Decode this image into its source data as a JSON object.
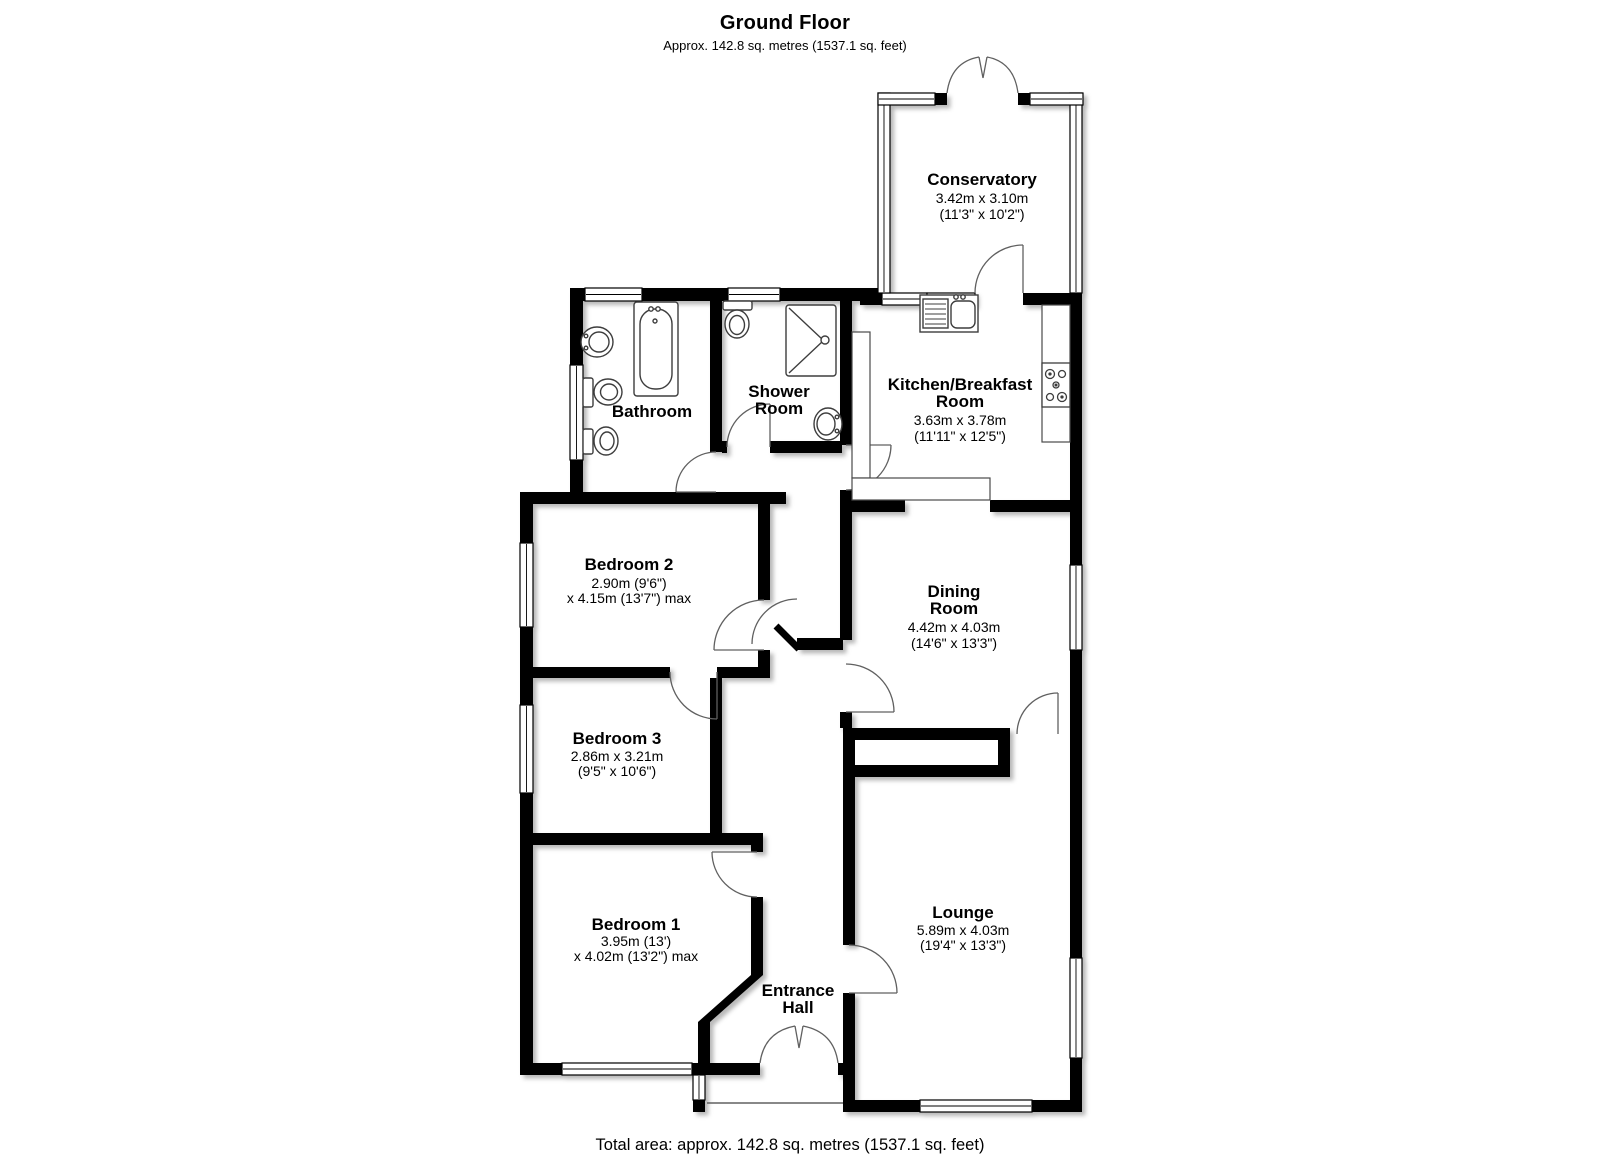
{
  "title": {
    "heading": "Ground Floor",
    "subheading": "Approx. 142.8 sq. metres (1537.1 sq. feet)"
  },
  "footer": {
    "total_area": "Total area: approx. 142.8 sq. metres (1537.1 sq. feet)"
  },
  "rooms": [
    {
      "id": "conservatory",
      "cx": 982,
      "lines": [
        {
          "text": "Conservatory",
          "bold": true,
          "y": 185
        },
        {
          "text": "3.42m x 3.10m",
          "bold": false,
          "y": 203
        },
        {
          "text": "(11'3\" x 10'2\")",
          "bold": false,
          "y": 219
        }
      ]
    },
    {
      "id": "kitchen-breakfast-room",
      "cx": 960,
      "lines": [
        {
          "text": "Kitchen/Breakfast",
          "bold": true,
          "y": 390
        },
        {
          "text": "Room",
          "bold": true,
          "y": 407
        },
        {
          "text": "3.63m x 3.78m",
          "bold": false,
          "y": 425
        },
        {
          "text": "(11'11\" x 12'5\")",
          "bold": false,
          "y": 441
        }
      ]
    },
    {
      "id": "bathroom",
      "cx": 652,
      "lines": [
        {
          "text": "Bathroom",
          "bold": true,
          "y": 417
        }
      ]
    },
    {
      "id": "shower-room",
      "cx": 779,
      "lines": [
        {
          "text": "Shower",
          "bold": true,
          "y": 397
        },
        {
          "text": "Room",
          "bold": true,
          "y": 414
        }
      ]
    },
    {
      "id": "bedroom-2",
      "cx": 629,
      "lines": [
        {
          "text": "Bedroom 2",
          "bold": true,
          "y": 570
        },
        {
          "text": "2.90m (9'6\")",
          "bold": false,
          "y": 588
        },
        {
          "text": "x 4.15m (13'7\") max",
          "bold": false,
          "y": 603
        }
      ]
    },
    {
      "id": "dining-room",
      "cx": 954,
      "lines": [
        {
          "text": "Dining",
          "bold": true,
          "y": 597
        },
        {
          "text": "Room",
          "bold": true,
          "y": 614
        },
        {
          "text": "4.42m x 4.03m",
          "bold": false,
          "y": 632
        },
        {
          "text": "(14'6\" x 13'3\")",
          "bold": false,
          "y": 648
        }
      ]
    },
    {
      "id": "bedroom-3",
      "cx": 617,
      "lines": [
        {
          "text": "Bedroom 3",
          "bold": true,
          "y": 744
        },
        {
          "text": "2.86m x 3.21m",
          "bold": false,
          "y": 761
        },
        {
          "text": "(9'5\" x 10'6\")",
          "bold": false,
          "y": 776
        }
      ]
    },
    {
      "id": "bedroom-1",
      "cx": 636,
      "lines": [
        {
          "text": "Bedroom 1",
          "bold": true,
          "y": 930
        },
        {
          "text": "3.95m (13')",
          "bold": false,
          "y": 946
        },
        {
          "text": "x 4.02m (13'2\") max",
          "bold": false,
          "y": 961
        }
      ]
    },
    {
      "id": "entrance-hall",
      "cx": 798,
      "lines": [
        {
          "text": "Entrance",
          "bold": true,
          "y": 996
        },
        {
          "text": "Hall",
          "bold": true,
          "y": 1013
        }
      ]
    },
    {
      "id": "lounge",
      "cx": 963,
      "lines": [
        {
          "text": "Lounge",
          "bold": true,
          "y": 918
        },
        {
          "text": "5.89m x 4.03m",
          "bold": false,
          "y": 935
        },
        {
          "text": "(19'4\" x 13'3\")",
          "bold": false,
          "y": 950
        }
      ]
    }
  ],
  "fixtures": [
    "bathtub",
    "wash-basin",
    "toilet",
    "bidet",
    "shower-cubicle",
    "kitchen-sink-drainer",
    "hob",
    "kitchen-counter"
  ],
  "colors": {
    "wall": "#000000",
    "floor": "#ffffff",
    "door-arc": "#606060",
    "fixture-outline": "#3d3d3d"
  }
}
